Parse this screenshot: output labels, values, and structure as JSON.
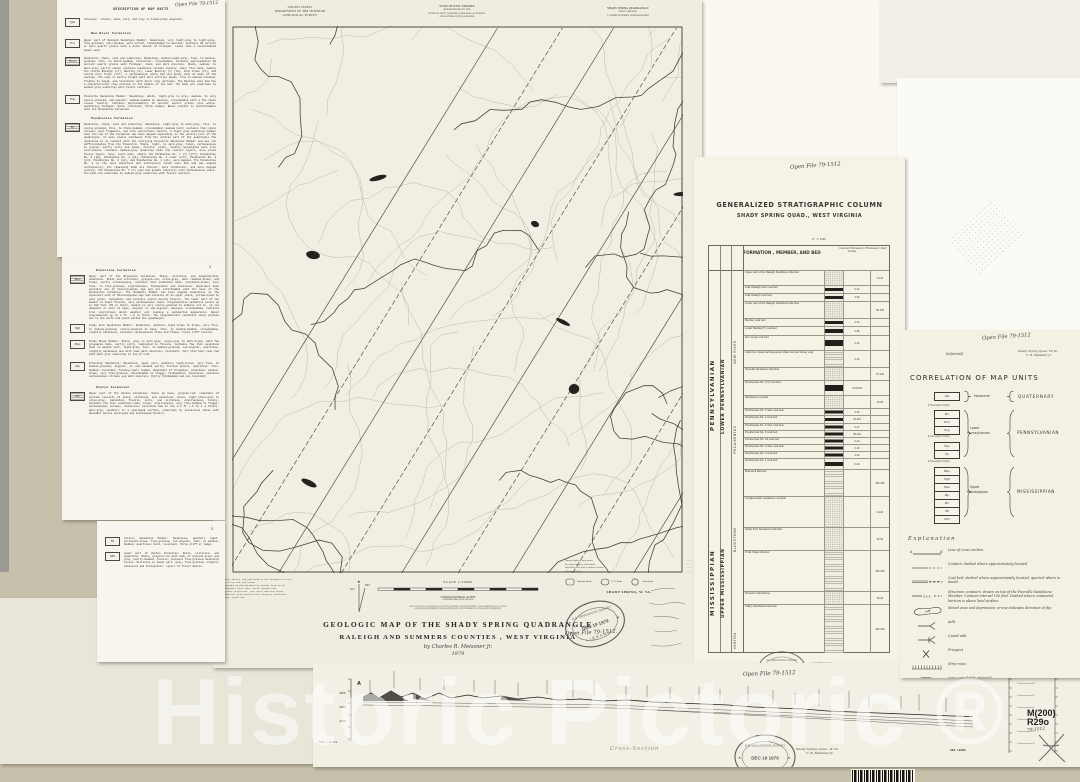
{
  "watermark": {
    "text": "Historic Pictoric ®"
  },
  "annotations": {
    "open_file": "Open File 79-1512",
    "open_file_dot": "Open File 79-1512.",
    "informal": "(informal)",
    "quad_note_line1": "Shady Spring Quad., W. Va.",
    "quad_note_line2": "C. R. Meissner Jr.",
    "byline": "by Charles R. Meissner Jr.",
    "year": "1979",
    "cross_section_caption": "Cross-Section",
    "catalog_hw": "79-1512",
    "author_small": "C. R. Meissner, Jr."
  },
  "stamp": {
    "top": "U.S. GEOLOGICAL SURVEY",
    "date": "DEC 19 1979",
    "bottom": "LIBRARY",
    "star": "★"
  },
  "catalog": {
    "line1": "M(200)",
    "line2": "R29o"
  },
  "description": {
    "title": "DESCRIPTION OF MAP UNITS",
    "page2_number": "2",
    "page3_number": "3",
    "page1_items": [
      {
        "type": "unit",
        "code": "Qal",
        "mt": 7,
        "text": "Alluvium - Gravel, sand, silt, and clay in flood-plain deposits."
      },
      {
        "type": "heading",
        "mt": 5,
        "text": "New River Formation"
      },
      {
        "type": "unit",
        "code": "Pnr",
        "mt": 4,
        "text": "Upper part of Raleigh Sandstone Member:  Sandstone, very light-gray to light-gray, fine-grained, sub-rounded, well-sorted, thickbedded to massive; contains 90 percent or more quartz grains with a minor amount of feldspar.  Looks like a consolidated beach sand."
      },
      {
        "type": "unit",
        "code": "Pnrc",
        "pat": true,
        "mt": 5,
        "text": "Sandstone, shale, coal and underclay:  Sandstone, medium-light-gray, fine- to medium-grained, thin- to thick-bedded, lenticular, crossbedded.  Contains approximately 60 percent quartz grains with feldspar, mica, and dark minerals.  Shale, medium- to dark-gray, partly sandy; contains sandstone streaks locally.  Coal, five beds, namely the Little Raleigh (lr), Beckley (b), Lower Beckley (?) (lb), Fire Creek (fc), and Little Fire Creek (lfc), a carbonaceous shale bed and boney coal at base of the section.  The coal is mostly bright with dull attrital bands, fine to medium cleated, friable to tough, and lenticular with minor clay partings.  The Beckley coal bed has a characteristic clay parting in the middle of the bed.  The beds are underlain by medium gray underclay with fossil rootlets."
      },
      {
        "type": "unit",
        "code": "Pnp",
        "mt": 6,
        "text": "Pineville Sandstone Member:  Sandstone, white, light-gray to gray, medium- to very coarse-grained, sub-angular; medium-bedded to massive, crossbedded with a few shale lenses locally.  Contains approximately 70 percent quartz grains plus white-weathering feldspar.  Hard, resistant, forms ledges.  Basal contact is unconformable with the Pocahontas Formation."
      },
      {
        "type": "heading",
        "mt": 6,
        "text": "Pocahontas Formation"
      },
      {
        "type": "unit",
        "code": "Pp",
        "pat": true,
        "mt": 3,
        "text": "Sandstone, shale, coal and underclay:  Sandstone, light-gray to dark-gray, fine- to coarse-grained, thin- to thick-bedded, crossbedded; medium hard; contains thin shale streaks, coal fragments, and iron concretions locally.  A light gray sandstone member near the top of the formation has been mapped separately in the central part of the quadrangle.  In many places southwest from the central part of the quadrangle the sandstone is in contact with the overlying Pineville Sandstone Member and was not differentiated from the Pineville.  Shale, light- to dark-gray, black, carbonaceous in places; partly silty and sandy, fissile, platy, locally associated with iron concretions, contains medium-gray underclay beds and rootlet layers, also plant fossil layers.  Coal, seven beds, namely the Pocahontas No. 7 (?) (p7?), Pocahontas No. 6 (p6), Pocahontas No. 4 (p4), Pocahontas No. 3 rider (p3r), Pocahontas No. 3 (p3), Pocahontas No. 2 (p2), and Pocahontas No. 1 (p1), were mapped.  The Pocahontas No. 3 is the most important and extensively mined coal bed and was mapped continuously; the remaining beds are thinner, more lenticular, and were mapped locally.  The Pocahontas No. 7 (?) coal bed grades laterally into carbonaceous shale.  The beds are underlain by medium-gray underclay with fossil rootlets."
      }
    ],
    "page2_items": [
      {
        "type": "heading",
        "mt": 12,
        "text": "Bluestone Formation"
      },
      {
        "type": "unit",
        "code": "Mbu",
        "pat": true,
        "mt": 3,
        "text": "Upper part of the Bluestone Formation:  Shale, siltstone, and conglomeratic sandstone.  Shale and siltstone, grayish-red, olive-gray, dark reddish-brown, and brown; partly carbonaceous, contains thin sandstone beds, yellowish-brown, very fine- to fine-grained, argillaceous, feldspathic and micaceous.  Uppermost beds possibly are of Pennsylvanian age and are interbedded with the base of the Pocahontas Formation.  The Bramwell Member has been mapped separately as the uppermost unit of Mississippian age and consists of an upper shale, yellow-brown to pale green, laminated, and contains scarce marine fossils.  The lower part of the member is black fissile, very carbonaceous shale.  Conglomeratic sandstone lenses up to 100 feet (30 m) thick, medium to very coarse-grained to pebbles 1/2 in. (1 cm) diameter or more at base, angular to sub-angular, massive, crossbedded.  Contains iron concretions which weather out leaving a pockmarked appearance.  Basal conglomerate up to 2 ft. (.6 m) thick.  The conglomeratic sandstone lense pinches out to the north and south within the quadrangle."
      },
      {
        "type": "unit",
        "code": "Mgf",
        "mt": 4,
        "text": "Glady Fork Sandstone Member:  Sandstone, weathers light-brown to brown, very fine- to medium-grained, coarse-grained at base, thin- to medium-bedded, crossbedded, slightly micaceous, contains carbonaceous films and flakes.  Forms cliff locally."
      },
      {
        "type": "unit",
        "code": "Mps",
        "mt": 6,
        "text": "Pride Shale Member:  Shale, gray to dark-gray, olive-gray to dark-brown, with few graywacke beds, partly silty, laminated to fissile.  Contains few thin sandstone beds in middle part, light-gray, fine- to medium-grained, sub-angular, quartzose, slightly micaceous and with some dark minerals; resistant.  Very thin bony coal bed with dark-gray underclay at top of unit."
      },
      {
        "type": "unit",
        "code": "Mp",
        "mt": 6,
        "text": "Princeton Sandstone:  Sandstone, upper part, weathers light-brown, very fine- to medium-grained, angular, in sub-rounded partly frosted grains, quartzose; thin-bedded; resistant, forming small ledges.  Remainder of formation, sandstone, medium-brown, very fine-grained, thickbedded to flaggy; feldspathic, micaceous, contains carbonaceous streaks and dark minerals.  Partly thinbedded and non-resistant."
      },
      {
        "type": "heading",
        "mt": 8,
        "text": "Hinton Formation"
      },
      {
        "type": "unit",
        "code": "Mh",
        "pat": true,
        "mt": 3,
        "text": "Upper part of the Hinton Formation:  Shale at base, grayish-red; remainder of section consists of shale, siltstone, and sandstone; shale, light-olive-gray to olive-gray, laminated, fissile, silty, and siltstone, argillaceous, blocky.  Contains few thin sandstone beds, brown, argillaceous, very thin-bedded to flaggy; carbonaceous streaks.  Calcareous siltstone bed at top 2-3 ft (.6 to 1 m thick), dark-gray, weathers to a scalloped surface, underlain by calcareous shale with abundant marine pelecypod and brachiopod fossils."
      }
    ],
    "page3_items": [
      {
        "type": "unit",
        "code": "Mt",
        "mt": 16,
        "text": "Tallery Sandstone Member:  Sandstone, weathers light-yellowish-brown, fine-grained, sub-angular, thin- to medium-bedded; quartzose; hard, resistant, forms cliff or ledge."
      },
      {
        "type": "unit",
        "code": "Mhl",
        "mt": 5,
        "text": "Lower part of Hinton Formation:  Shale, siltstone, and sandstone.  Shale, grayish-red with beds of grayish-green and gray, poorly-bedded, fissile; contains fine-grained sandstone lenses; Siltstone in basal part, gray, fine-grained, slightly micaceous and feldspathic; layers of fossil debris."
      }
    ]
  },
  "map_sheet": {
    "header_left": [
      "UNITED STATES",
      "DEPARTMENT OF THE INTERIOR",
      "GEOLOGICAL SURVEY"
    ],
    "header_center": [
      "STATE OF WEST VIRGINIA",
      "REPRESENTED BY THE",
      "STATE OF WEST VIRGINIA GEOLOGICAL SURVEY",
      "AND OTHER STATE AGENCIES"
    ],
    "header_right": [
      "SHADY SPRING QUADRANGLE",
      "WEST VIRGINIA",
      "7.5 MINUTE SERIES (TOPOGRAPHIC)"
    ],
    "credit_lines": [
      "Mapped, edited, and published by the Geological Survey",
      "Control by USGS and USC&GS",
      "Topography by photogrammetric methods from aerial",
      "photographs taken 1963.  Field checked 1965",
      "Polyconic projection.  1927 North American datum",
      "10,000-foot grid based on West Virginia coordinate",
      "system, south zone"
    ],
    "scale_label": "SCALE 1:24000",
    "contour_note": "CONTOUR INTERVAL 40 FEET",
    "datum_note": "DATUM IS MEAN SEA LEVEL",
    "sale_line1": "FOR SALE BY U. S. GEOLOGICAL SURVEY, DENVER, COLORADO 80225, OR WASHINGTON, D. C. 20242",
    "sale_line2": "A FOLDER DESCRIBING TOPOGRAPHIC MAPS AND SYMBOLS IS AVAILABLE ON REQUEST",
    "road_class_lines": [
      "Primary highway, hard surface",
      "Secondary highway, hard surface",
      "Light-duty road, hard or improved surface",
      "Unimproved road"
    ],
    "route_types": [
      "Interstate Route",
      "U. S. Route",
      "State Route"
    ],
    "quad_name_label": "SHADY SPRING, W. VA.",
    "declination_mn": "MN",
    "declination_gn": "GN",
    "title_line1": "GEOLOGIC MAP OF THE SHADY SPRING QUADRANGLE",
    "title_line2": "RALEIGH AND SUMMERS COUNTIES , WEST VIRGINIA"
  },
  "strat_column": {
    "title": "GENERALIZED STRATIGRAPHIC COLUMN",
    "subtitle": "SHADY SPRING QUAD., WEST VIRGINIA",
    "scale_note": "1\" = 100'",
    "header": "FORMATION , MEMBER, AND BED",
    "coal_header": "Coal bed thickness (in inches)",
    "thick_header": "Thickness (in feet)",
    "system_labels": [
      "PENNSYLVANIAN",
      "MISSISSIPPIAN"
    ],
    "series_labels": [
      "LOWER PENNSYLVANIAN",
      "UPPER MISSISSIPPIAN"
    ],
    "formation_labels": [
      "NEW RIVER",
      "POCAHONTAS",
      "BLUESTONE",
      "HINTON"
    ],
    "rows": [
      {
        "label": "Upper part of the Raleigh Sandstone Member",
        "h": 14,
        "lith": "ss",
        "thick": "0-110"
      },
      {
        "label": "Little Raleigh rider coal bed",
        "h": 7,
        "lith": "coal",
        "coal": "0-22"
      },
      {
        "label": "Little Raleigh coal bed",
        "h": 7,
        "lith": "coal",
        "coal": "4-30"
      },
      {
        "label": "Lower part of the Raleigh Sandstone Member",
        "h": 16,
        "lith": "ss",
        "thick": "86-135"
      },
      {
        "label": "Beckley coal bed",
        "h": 7,
        "lith": "coal",
        "coal": "4-70"
      },
      {
        "label": "Lower Beckley(?) coal bed",
        "h": 8,
        "lith": "coal",
        "coal": "0-36"
      },
      {
        "label": "Fire Creek coal bed",
        "h": 14,
        "lith": "coal",
        "coal": "2-12"
      },
      {
        "label": "Little Fire Creek carbonaceous shale bed and boney coal",
        "h": 16,
        "lith": "sh",
        "coal": "0-12"
      },
      {
        "label": "Pineville Sandstone Member",
        "h": 12,
        "lith": "ss",
        "thick": "57-148"
      },
      {
        "label": "Pocahontas No. 7(?) coal bed",
        "h": 14,
        "lith": "coal",
        "coal": "0-100-60"
      },
      {
        "label": "Sandstone member",
        "h": 12,
        "lith": "ss",
        "thick": "30-60"
      },
      {
        "label": "Pocahontas No. 4 rider coal bed",
        "h": 6,
        "lith": "coal",
        "coal": "0-12"
      },
      {
        "label": "Pocahontas No. 4 coal bed",
        "h": 7,
        "lith": "coal",
        "coal": "18-210"
      },
      {
        "label": "Pocahontas No. 3 rider coal bed",
        "h": 6,
        "lith": "coal",
        "coal": "0-27"
      },
      {
        "label": "Pocahontas No. 3 coal bed",
        "h": 6,
        "lith": "coal",
        "coal": "28-146"
      },
      {
        "label": "Pocahontas No. 3A coal bed",
        "h": 6,
        "lith": "coal",
        "coal": "0-24"
      },
      {
        "label": "Pocahontas No. 2 rider coal bed",
        "h": 6,
        "lith": "coal",
        "coal": "0-16"
      },
      {
        "label": "Pocahontas No. 2 coal bed",
        "h": 6,
        "lith": "coal",
        "coal": "4-40"
      },
      {
        "label": "Pocahontas No. 1 coal bed",
        "h": 10,
        "lith": "coal",
        "coal": "0-20"
      },
      {
        "label": "Bramwell Member",
        "h": 26,
        "lith": "sh",
        "thick": "100-150"
      },
      {
        "label": "Conglomeratic sandstone member",
        "h": 30,
        "lith": "ss",
        "thick": "0-100"
      },
      {
        "label": "Glady Fork Sandstone Member",
        "h": 22,
        "lith": "ss",
        "thick": "42-90"
      },
      {
        "label": "Pride Shale Member",
        "h": 40,
        "lith": "sh",
        "thick": "180-250"
      },
      {
        "label": "Princeton Sandstone",
        "h": 12,
        "lith": "ss",
        "thick": "25-40"
      },
      {
        "label": "Tallery Sandstone Member",
        "h": 48,
        "lith": "sh",
        "thick": "150-200"
      }
    ]
  },
  "correlation": {
    "title": "CORRELATION OF MAP UNITS",
    "qal": "Qal",
    "holocene": "Holocene",
    "quaternary": "QUATERNARY",
    "unconformity": "Unconformity",
    "penn_group1": [
      "Pnr",
      "Pnrc",
      "Pnp"
    ],
    "penn_group2": [
      "Pps",
      "Pp"
    ],
    "penn_epoch_line1": "Lower",
    "penn_epoch_line2": "Pennsylvanian",
    "penn_system": "PENNSYLVANIAN",
    "miss_units": [
      "Mbu",
      "Mgf",
      "Mps",
      "Mp",
      "Mh",
      "Mt",
      "Mhl"
    ],
    "miss_epoch_line1": "Upper",
    "miss_epoch_line2": "Mississippian",
    "miss_system": "MISSISSIPPIAN"
  },
  "explanation": {
    "title": "Explanation",
    "items": [
      {
        "symbol": "section-line",
        "label": "Line of cross section"
      },
      {
        "symbol": "contact",
        "label": "Contact: dashed where approximately located"
      },
      {
        "symbol": "coal-bed",
        "label": "Coal bed: dashed where approximately located, queried where in doubt"
      },
      {
        "symbol": "structure-contour",
        "label": "Structure contours: drawn on top of the Pineville Sandstone Member.  Contour interval 100 feet.  Dashed where contoured horizon is above land surface."
      },
      {
        "symbol": "mined-area",
        "label": "Mined area and depression; arrow indicates direction of dip"
      },
      {
        "symbol": "adit",
        "label": "Adit"
      },
      {
        "symbol": "caved-adit",
        "label": "Caved adit"
      },
      {
        "symbol": "prospect",
        "label": "Prospect"
      },
      {
        "symbol": "strip-mine",
        "label": "Strip mine"
      },
      {
        "symbol": "stripped-area",
        "label": "Area completely stripped"
      },
      {
        "symbol": "rock-quarry",
        "label": "Rock quarry"
      }
    ]
  },
  "cross_section": {
    "end_label": "A",
    "sea_level": "SEA LEVEL",
    "elev_labels": [
      "3000'",
      "2000'",
      "1000'"
    ]
  }
}
